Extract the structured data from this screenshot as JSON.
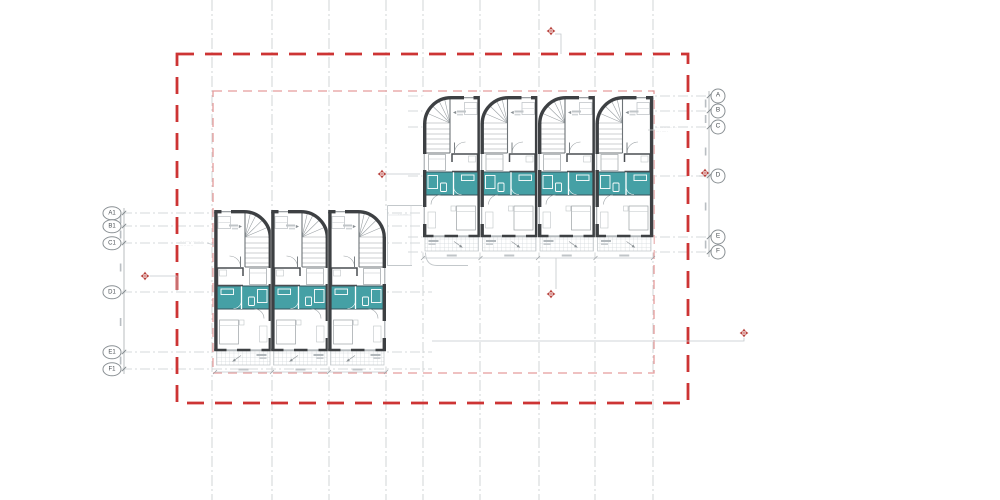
{
  "drawing": {
    "type": "architectural-floor-plan",
    "colors": {
      "teal_room_fill": "#45a0a5",
      "wall_dark": "#3d4043",
      "boundary_outer_red": "#cd3434",
      "boundary_inner_pink": "#e59c9c",
      "grid_gray": "#c6cacd",
      "marker_red": "#b8403a"
    },
    "right_grid": {
      "bubble_x": 718,
      "dim_x": 709,
      "extent": [
        408,
        712
      ],
      "labels": [
        "A",
        "B",
        "C",
        "D",
        "E",
        "F"
      ],
      "ys": [
        96,
        111,
        127,
        176,
        237,
        252
      ]
    },
    "left_grid": {
      "bubble_x": 112,
      "dim_x": 124,
      "extent": [
        122,
        432
      ],
      "labels": [
        "A1",
        "B1",
        "C1",
        "D1",
        "E1",
        "F1"
      ],
      "ys": [
        213,
        226,
        243,
        292,
        352,
        369
      ]
    },
    "vertical_grid_x": [
      212,
      272,
      329,
      386,
      423,
      480,
      539,
      595,
      653
    ],
    "boundary_outer": {
      "x": 177,
      "y": 54,
      "w": 511,
      "h": 349
    },
    "boundary_inner": {
      "x": 213,
      "y": 91,
      "w": 441,
      "h": 282
    },
    "blocks": [
      {
        "name": "upper-terrace-block",
        "x": 423,
        "y": 96,
        "count": 4,
        "unit_w": 57.5,
        "mirror": false
      },
      {
        "name": "lower-terrace-block",
        "x": 215,
        "y": 210,
        "count": 3,
        "unit_w": 57,
        "mirror": true
      }
    ],
    "markers": [
      [
        551,
        31
      ],
      [
        382,
        174
      ],
      [
        705,
        173
      ],
      [
        145,
        276
      ],
      [
        551,
        294
      ],
      [
        744,
        333
      ]
    ],
    "leaders": [
      [
        [
          555,
          34
        ],
        [
          561,
          34
        ],
        [
          561,
          54
        ]
      ],
      [
        [
          387,
          174
        ],
        [
          420,
          174
        ]
      ],
      [
        [
          699,
          176
        ],
        [
          712,
          176
        ]
      ],
      [
        [
          150,
          276
        ],
        [
          177,
          276
        ],
        [
          177,
          291
        ]
      ],
      [
        [
          556,
          289
        ],
        [
          556,
          258
        ]
      ],
      [
        [
          744,
          338
        ],
        [
          744,
          341
        ],
        [
          432,
          341
        ]
      ],
      [
        [
          214,
          245
        ],
        [
          207,
          243
        ]
      ],
      [
        [
          648,
          130
        ],
        [
          655,
          130
        ]
      ]
    ],
    "notes": {
      "lower_note": {
        "line1": "·· ······· ······ ··",
        "line2": "····· ·····"
      },
      "upper_note": {
        "line1": "······ ········ ··",
        "line2": "···· ·····"
      },
      "pad_note": {
        "line1": "· ·······"
      }
    }
  }
}
